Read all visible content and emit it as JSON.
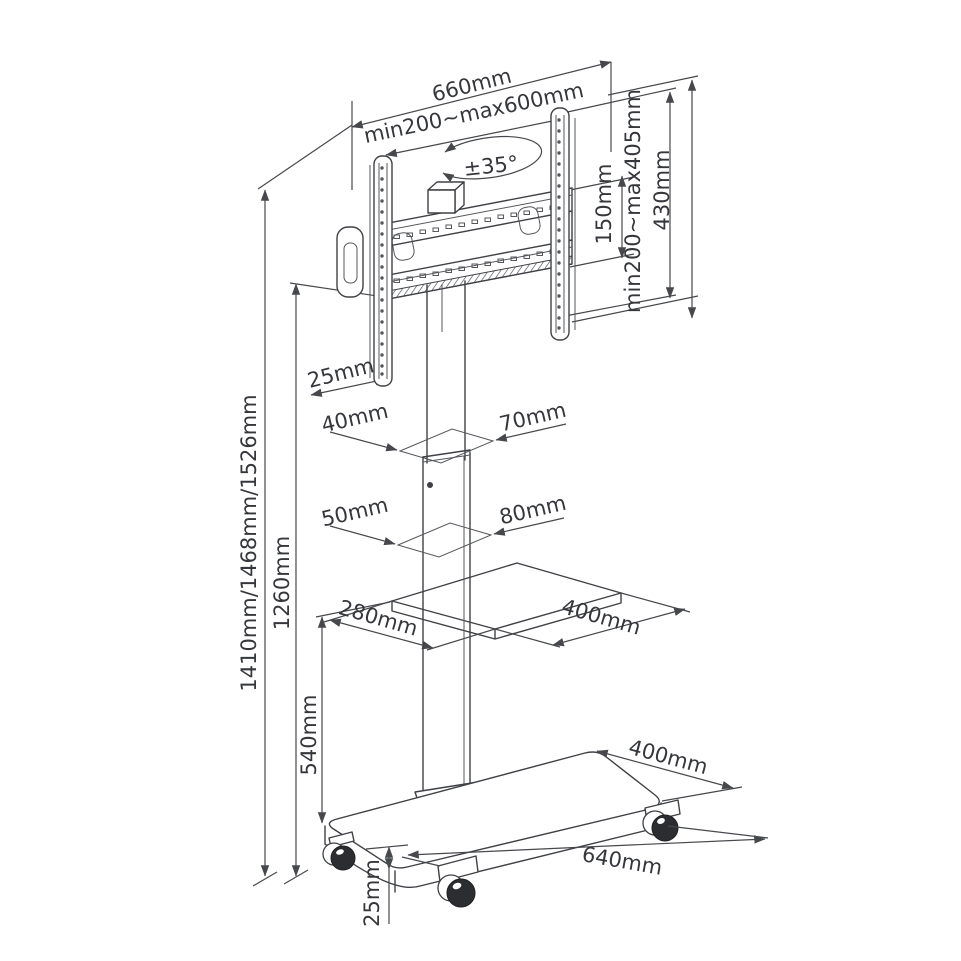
{
  "diagram": {
    "labels": {
      "bracket_width": "660mm",
      "vesa_width_range": "min200~max600mm",
      "swivel_angle": "±35°",
      "rail_height": "150mm",
      "vesa_height_range": "min200~max405mm",
      "bracket_height": "430mm",
      "bracket_offset": "25mm",
      "upper_column_depth": "40mm",
      "upper_column_width": "70mm",
      "lower_column_depth": "50mm",
      "lower_column_width": "80mm",
      "shelf_depth": "280mm",
      "shelf_width": "400mm",
      "overall_heights": "1410mm/1468mm/1526mm",
      "column_height": "1260mm",
      "shelf_height": "540mm",
      "base_depth": "400mm",
      "base_length": "640mm",
      "base_thickness": "25mm"
    }
  }
}
